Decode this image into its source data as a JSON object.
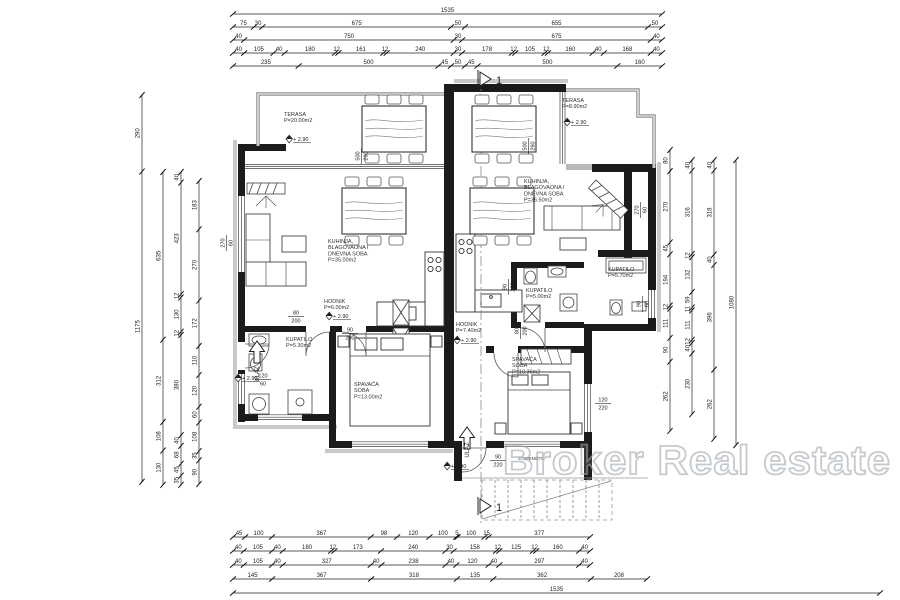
{
  "watermark": "Broker Real estate",
  "section": {
    "label": "1"
  },
  "level_text": "+ 2.90",
  "colors": {
    "wall": "#1b1b1b",
    "parapet": "#8f8f8f",
    "watermark_stroke": "#9aa1a8",
    "dim_text": "#222222"
  },
  "rooms": [
    {
      "id": "terasa-left",
      "lines": [
        "TERASA",
        "P=20.00m2"
      ],
      "x": 284,
      "y": 116
    },
    {
      "id": "terasa-right",
      "lines": [
        "TERASA",
        "P=8.90m2"
      ],
      "x": 562,
      "y": 102
    },
    {
      "id": "living-left",
      "lines": [
        "KUHINJA,",
        "BLAGOVAONA I",
        "DNEVNA SOBA",
        "P=35.00m2"
      ],
      "x": 328,
      "y": 243
    },
    {
      "id": "living-right",
      "lines": [
        "KUHINJA,",
        "BLAGOVAONA I",
        "DNEVNA SOBA",
        "P=36.50m2"
      ],
      "x": 524,
      "y": 183
    },
    {
      "id": "hodnik-left",
      "lines": [
        "HODNIK",
        "P=6.00m2"
      ],
      "x": 324,
      "y": 303
    },
    {
      "id": "hodnik-right",
      "lines": [
        "HODNIK",
        "P=7.40m2"
      ],
      "x": 456,
      "y": 326
    },
    {
      "id": "kupatilo-left",
      "lines": [
        "KUPATILO",
        "P=5.30m2"
      ],
      "x": 286,
      "y": 341
    },
    {
      "id": "kupatilo-right",
      "lines": [
        "KUPATILO",
        "P=5.00m2"
      ],
      "x": 526,
      "y": 292
    },
    {
      "id": "kupatilo-far-right",
      "lines": [
        "KUPATILO",
        "P=5.70m2"
      ],
      "x": 608,
      "y": 271
    },
    {
      "id": "spavaca-left",
      "lines": [
        "SPAVAĆA",
        "SOBA",
        "P=13.00m2"
      ],
      "x": 354,
      "y": 386
    },
    {
      "id": "spavaca-right",
      "lines": [
        "SPAVAĆA",
        "SOBA",
        "P=10.36m2"
      ],
      "x": 512,
      "y": 361
    }
  ],
  "level_markers": [
    {
      "x": 294,
      "y": 140
    },
    {
      "x": 572,
      "y": 123
    },
    {
      "x": 334,
      "y": 317
    },
    {
      "x": 462,
      "y": 341
    },
    {
      "x": 243,
      "y": 379
    },
    {
      "x": 452,
      "y": 467
    }
  ],
  "annotations": [
    {
      "text": "ULAZ",
      "x": 259,
      "y": 374,
      "rot": -90,
      "size": 6
    },
    {
      "text": "ULAZ",
      "x": 469,
      "y": 450,
      "rot": -90,
      "size": 6
    },
    {
      "text": "STEPENIŠTE",
      "x": 531,
      "y": 460,
      "rot": 0,
      "size": 4.2
    }
  ],
  "fractions": [
    {
      "t": "120",
      "b": "60",
      "x": 263,
      "y": 379,
      "rot": 0
    },
    {
      "t": "80",
      "b": "200",
      "x": 296,
      "y": 316,
      "rot": 0
    },
    {
      "t": "90",
      "b": "200",
      "x": 350,
      "y": 333,
      "rot": 0
    },
    {
      "t": "500",
      "b": "260",
      "x": 361,
      "y": 156,
      "rot": -90
    },
    {
      "t": "500",
      "b": "260",
      "x": 528,
      "y": 146,
      "rot": -90
    },
    {
      "t": "270",
      "b": "60",
      "x": 226,
      "y": 243,
      "rot": -90
    },
    {
      "t": "270",
      "b": "60",
      "x": 640,
      "y": 210,
      "rot": -90
    },
    {
      "t": "90",
      "b": "200",
      "x": 508,
      "y": 287,
      "rot": -90
    },
    {
      "t": "80",
      "b": "200",
      "x": 520,
      "y": 331,
      "rot": -90
    },
    {
      "t": "90",
      "b": "220",
      "x": 498,
      "y": 460,
      "rot": 0
    },
    {
      "t": "120",
      "b": "220",
      "x": 603,
      "y": 403,
      "rot": 0
    },
    {
      "t": "90",
      "b": "60",
      "x": 642,
      "y": 304,
      "rot": -90
    }
  ],
  "dims": {
    "top": {
      "rows": [
        {
          "y": 14,
          "x1": 233,
          "x2": 662,
          "segs": [
            1535
          ]
        },
        {
          "y": 27,
          "x1": 233,
          "x2": 662,
          "segs": [
            75,
            30,
            675,
            50,
            655,
            50
          ]
        },
        {
          "y": 40,
          "x1": 233,
          "x2": 662,
          "segs": [
            40,
            750,
            30,
            675,
            40
          ]
        },
        {
          "y": 53,
          "x1": 233,
          "x2": 662,
          "segs": [
            40,
            105,
            40,
            180,
            12,
            161,
            12,
            240,
            30,
            178,
            12,
            105,
            12,
            160,
            40,
            168,
            40
          ]
        },
        {
          "y": 66,
          "x1": 233,
          "x2": 662,
          "segs": [
            235,
            500,
            45,
            50,
            45,
            500,
            160
          ]
        }
      ]
    },
    "bottom": {
      "rows": [
        {
          "y": 537,
          "x1": 233,
          "x2": 590,
          "segs": [
            45,
            100,
            367,
            98,
            120,
            100,
            5,
            100,
            15,
            377
          ]
        },
        {
          "y": 551,
          "x1": 233,
          "x2": 590,
          "segs": [
            40,
            105,
            40,
            180,
            12,
            173,
            240,
            30,
            158,
            12,
            125,
            12,
            160,
            40
          ]
        },
        {
          "y": 565,
          "x1": 233,
          "x2": 590,
          "segs": [
            40,
            105,
            40,
            327,
            40,
            238,
            40,
            120,
            40,
            297,
            40
          ]
        },
        {
          "y": 579,
          "x1": 233,
          "x2": 647,
          "segs": [
            145,
            367,
            318,
            135,
            362,
            208
          ]
        },
        {
          "y": 593,
          "x1": 233,
          "x2": 880,
          "segs": [
            1535
          ]
        }
      ]
    },
    "left_cols": [
      {
        "x": 142,
        "y1": 95,
        "segs": [
          290,
          1175
        ]
      },
      {
        "x": 163,
        "y1": 172,
        "segs": [
          635,
          312,
          108,
          130
        ]
      },
      {
        "x": 181,
        "y1": 172,
        "segs": [
          40,
          423,
          12,
          130,
          12,
          380,
          40,
          68,
          45,
          35
        ]
      },
      {
        "x": 199,
        "y1": 181,
        "segs": [
          183,
          270,
          172,
          110,
          120,
          60,
          108,
          35,
          90
        ]
      }
    ],
    "right_cols": [
      {
        "x": 670,
        "y1": 150,
        "segs": [
          80,
          270,
          45,
          194,
          12,
          111,
          90,
          262
        ]
      },
      {
        "x": 692,
        "y1": 160,
        "segs": [
          40,
          316,
          12,
          132,
          59,
          11,
          111,
          12,
          40,
          230
        ]
      },
      {
        "x": 714,
        "y1": 160,
        "segs": [
          40,
          318,
          40,
          396,
          262
        ]
      },
      {
        "x": 736,
        "y1": 160,
        "segs": [
          1080
        ]
      }
    ]
  }
}
